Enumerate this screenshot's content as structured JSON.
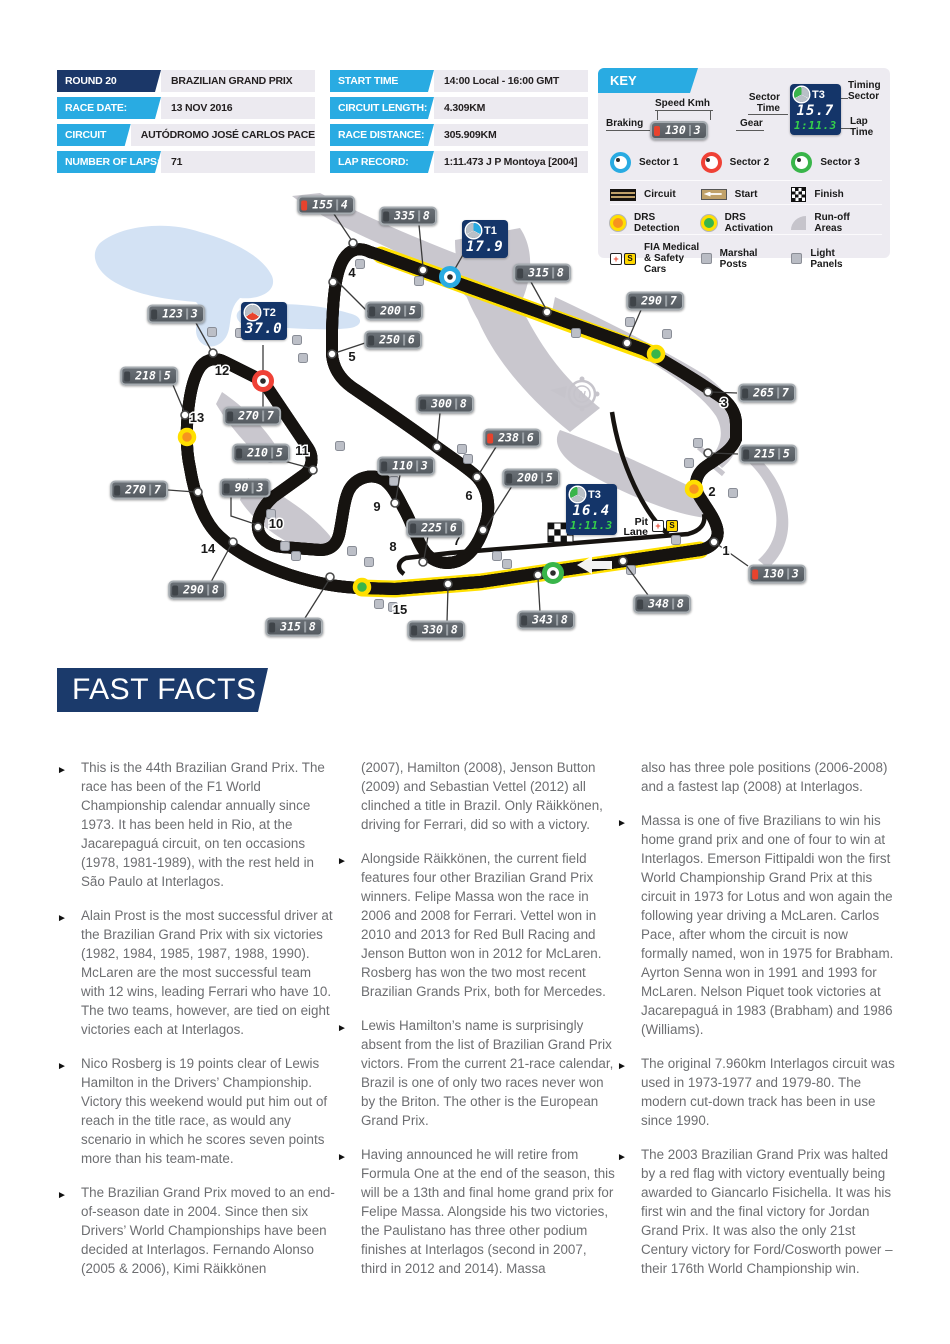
{
  "info_tables": {
    "left": {
      "rows": [
        {
          "label": "ROUND 20",
          "value": "BRAZILIAN GRAND PRIX",
          "variant": "navy"
        },
        {
          "label": "RACE DATE:",
          "value": "13 NOV 2016",
          "variant": "cyan"
        },
        {
          "label": "CIRCUIT NAME:",
          "value": "AUTÓDROMO JOSÉ CARLOS PACE",
          "variant": "cyan"
        },
        {
          "label": "NUMBER OF LAPS:",
          "value": "71",
          "variant": "cyan"
        }
      ]
    },
    "right": {
      "rows": [
        {
          "label": "START TIME",
          "value": "14:00 Local - 16:00 GMT",
          "variant": "cyan"
        },
        {
          "label": "CIRCUIT LENGTH:",
          "value": "4.309KM",
          "variant": "cyan"
        },
        {
          "label": "RACE DISTANCE:",
          "value": "305.909KM",
          "variant": "cyan"
        },
        {
          "label": "LAP RECORD:",
          "value": "1:11.473 J P Montoya [2004]",
          "variant": "cyan"
        }
      ]
    }
  },
  "key": {
    "title": "KEY",
    "speed_example": {
      "braking_label": "Braking",
      "speed_label": "Speed Kmh",
      "gear_label": "Gear",
      "speed": "130",
      "gear": "3"
    },
    "timing_example": {
      "sector_time_label": "Sector\nTime",
      "timing_sector_label": "Timing\nSector",
      "lap_time_label": "Lap\nTime",
      "sector_id": "T3",
      "sector_time": "15.7",
      "lap_time": "1:11.3"
    },
    "icon_glyphs": {
      "plus": "+",
      "safety": "S"
    },
    "sectors": [
      {
        "label": "Sector 1",
        "color": "#29abe2"
      },
      {
        "label": "Sector 2",
        "color": "#ef4136"
      },
      {
        "label": "Sector 3",
        "color": "#39b54a"
      }
    ],
    "track_items": [
      {
        "label": "Circuit",
        "icon": "circuit"
      },
      {
        "label": "Start",
        "icon": "start"
      },
      {
        "label": "Finish",
        "icon": "finish"
      }
    ],
    "drs_items": [
      {
        "label": "DRS\nDetection",
        "icon": "drs-detection"
      },
      {
        "label": "DRS\nActivation",
        "icon": "drs-activation"
      },
      {
        "label": "Run-off\nAreas",
        "icon": "runoff"
      }
    ],
    "misc_items": [
      {
        "label": "FIA Medical\n& Safety Cars",
        "icon": "medical-safety"
      },
      {
        "label": "Marshal\nPosts",
        "icon": "marshal"
      },
      {
        "label": "Light\nPanels",
        "icon": "light-panel"
      }
    ]
  },
  "map": {
    "compass_label": "N",
    "pit_lane_label": {
      "line1": "Pit",
      "line2": "Lane"
    },
    "colors": {
      "track_tan": "#c0a169",
      "drs_zone": "#ffe000",
      "sector1": "#29abe2",
      "sector2": "#ef4136",
      "sector3": "#39b54a",
      "timing_navy": "#143569"
    },
    "speed_boxes": [
      {
        "s": "155",
        "g": "4",
        "r": true,
        "cx": 326,
        "cy": 205,
        "ln": [
          [
            334,
            214
          ],
          [
            352,
            241
          ]
        ],
        "dot": [
          353,
          243
        ]
      },
      {
        "s": "335",
        "g": "8",
        "cx": 408,
        "cy": 216,
        "ln": [
          [
            419,
            225
          ],
          [
            423,
            267
          ]
        ],
        "dot": [
          423,
          270
        ]
      },
      {
        "s": "315",
        "g": "8",
        "cx": 542,
        "cy": 273,
        "ln": [
          [
            531,
            282
          ],
          [
            546,
            309
          ]
        ],
        "dot": [
          547,
          312
        ]
      },
      {
        "s": "290",
        "g": "7",
        "cx": 655,
        "cy": 301,
        "ln": [
          [
            641,
            310
          ],
          [
            628,
            340
          ]
        ],
        "dot": [
          627,
          343
        ]
      },
      {
        "s": "265",
        "g": "7",
        "cx": 767,
        "cy": 393,
        "ln": [
          [
            737,
            393
          ],
          [
            711,
            392
          ]
        ],
        "dot": [
          708,
          392
        ]
      },
      {
        "s": "215",
        "g": "5",
        "cx": 768,
        "cy": 454,
        "ln": [
          [
            738,
            454
          ],
          [
            711,
            453
          ]
        ],
        "dot": [
          708,
          453
        ]
      },
      {
        "s": "130",
        "g": "3",
        "r": true,
        "cx": 777,
        "cy": 574,
        "ln": [
          [
            748,
            566
          ],
          [
            717,
            544
          ]
        ],
        "dot": [
          714,
          542
        ]
      },
      {
        "s": "348",
        "g": "8",
        "cx": 662,
        "cy": 604,
        "ln": [
          [
            648,
            595
          ],
          [
            625,
            564
          ]
        ],
        "dot": [
          623,
          561
        ]
      },
      {
        "s": "343",
        "g": "8",
        "cx": 546,
        "cy": 620,
        "ln": [
          [
            540,
            612
          ],
          [
            538,
            578
          ]
        ],
        "dot": [
          538,
          575
        ]
      },
      {
        "s": "330",
        "g": "8",
        "cx": 436,
        "cy": 630,
        "ln": [
          [
            447,
            622
          ],
          [
            448,
            587
          ]
        ],
        "dot": [
          448,
          584
        ]
      },
      {
        "s": "315",
        "g": "8",
        "cx": 294,
        "cy": 627,
        "ln": [
          [
            305,
            618
          ],
          [
            329,
            580
          ]
        ],
        "dot": [
          330,
          577
        ]
      },
      {
        "s": "290",
        "g": "8",
        "cx": 197,
        "cy": 590,
        "ln": [
          [
            211,
            582
          ],
          [
            231,
            545
          ]
        ],
        "dot": [
          233,
          542
        ]
      },
      {
        "s": "270",
        "g": "7",
        "cx": 139,
        "cy": 490,
        "ln": [
          [
            168,
            490
          ],
          [
            195,
            492
          ]
        ],
        "dot": [
          198,
          492
        ]
      },
      {
        "s": "218",
        "g": "5",
        "cx": 149,
        "cy": 376,
        "ln": [
          [
            173,
            385
          ],
          [
            184,
            411
          ]
        ],
        "dot": [
          185,
          415
        ]
      },
      {
        "s": "123",
        "g": "3",
        "cx": 176,
        "cy": 314,
        "ln": [
          [
            196,
            323
          ],
          [
            211,
            350
          ]
        ],
        "dot": [
          213,
          353
        ]
      },
      {
        "s": "270",
        "g": "7",
        "cx": 252,
        "cy": 416,
        "ln": [
          [
            263,
            407
          ],
          [
            263,
            390
          ]
        ]
      },
      {
        "s": "210",
        "g": "5",
        "cx": 261,
        "cy": 453,
        "ln": [
          [
            284,
            461
          ],
          [
            310,
            468
          ]
        ],
        "dot": [
          313,
          470
        ]
      },
      {
        "s": "90",
        "g": "3",
        "cx": 245,
        "cy": 488,
        "ln": [
          [
            231,
            496
          ],
          [
            231,
            516
          ],
          [
            255,
            524
          ]
        ],
        "dot": [
          258,
          527
        ]
      },
      {
        "s": "110",
        "g": "3",
        "cx": 406,
        "cy": 466,
        "ln": [
          [
            400,
            475
          ],
          [
            396,
            499
          ]
        ],
        "dot": [
          395,
          503
        ]
      },
      {
        "s": "225",
        "g": "6",
        "cx": 435,
        "cy": 528,
        "ln": [
          [
            428,
            536
          ],
          [
            424,
            559
          ]
        ],
        "dot": [
          423,
          562
        ]
      },
      {
        "s": "200",
        "g": "5",
        "cx": 531,
        "cy": 478,
        "ln": [
          [
            512,
            486
          ],
          [
            486,
            527
          ]
        ],
        "dot": [
          483,
          530
        ]
      },
      {
        "s": "238",
        "g": "6",
        "r": true,
        "cx": 512,
        "cy": 438,
        "ln": [
          [
            496,
            447
          ],
          [
            479,
            474
          ]
        ],
        "dot": [
          477,
          477
        ]
      },
      {
        "s": "300",
        "g": "8",
        "cx": 445,
        "cy": 404,
        "ln": [
          [
            440,
            413
          ],
          [
            437,
            444
          ]
        ],
        "dot": [
          437,
          447
        ]
      },
      {
        "s": "200",
        "g": "5",
        "cx": 394,
        "cy": 311,
        "ln": [
          [
            376,
            320
          ],
          [
            336,
            280
          ]
        ],
        "dot": [
          333,
          282
        ]
      },
      {
        "s": "250",
        "g": "6",
        "cx": 393,
        "cy": 340,
        "ln": [
          [
            365,
            343
          ],
          [
            335,
            353
          ]
        ],
        "dot": [
          332,
          354
        ]
      }
    ],
    "timing_boxes": [
      {
        "id": "T1",
        "time": "17.9",
        "seg": "right",
        "x": 462,
        "y": 220,
        "ln": [
          [
            464,
            253
          ],
          [
            452,
            274
          ]
        ]
      },
      {
        "id": "T2",
        "time": "37.0",
        "seg": "bottom",
        "x": 241,
        "y": 302,
        "ln": [
          [
            263,
            345
          ],
          [
            263,
            374
          ]
        ]
      },
      {
        "id": "T3",
        "time": "16.4",
        "lap": "1:11.3",
        "seg": "left",
        "x": 566,
        "y": 484
      }
    ],
    "turns": [
      {
        "n": "1",
        "x": 726,
        "y": 555
      },
      {
        "n": "2",
        "x": 712,
        "y": 496
      },
      {
        "n": "3",
        "x": 724,
        "y": 407
      },
      {
        "n": "4",
        "x": 352,
        "y": 277
      },
      {
        "n": "5",
        "x": 352,
        "y": 361
      },
      {
        "n": "6",
        "x": 469,
        "y": 500
      },
      {
        "n": "7",
        "x": 457,
        "y": 545
      },
      {
        "n": "8",
        "x": 393,
        "y": 551
      },
      {
        "n": "9",
        "x": 377,
        "y": 511
      },
      {
        "n": "10",
        "x": 276,
        "y": 528
      },
      {
        "n": "11",
        "x": 302,
        "y": 455
      },
      {
        "n": "12",
        "x": 222,
        "y": 375
      },
      {
        "n": "13",
        "x": 197,
        "y": 422
      },
      {
        "n": "14",
        "x": 208,
        "y": 553
      },
      {
        "n": "15",
        "x": 400,
        "y": 614
      }
    ],
    "sector_markers": [
      {
        "color": "#29abe2",
        "x": 450,
        "y": 277
      },
      {
        "color": "#ef4136",
        "x": 263,
        "y": 381
      },
      {
        "color": "#39b54a",
        "x": 553,
        "y": 573
      }
    ],
    "drs_markers": [
      {
        "type": "detection",
        "x": 187,
        "y": 437
      },
      {
        "type": "detection",
        "x": 694,
        "y": 489
      },
      {
        "type": "activation",
        "x": 656,
        "y": 354
      },
      {
        "type": "activation",
        "x": 362,
        "y": 587
      }
    ],
    "marshal_posts": [
      [
        212,
        332
      ],
      [
        240,
        333
      ],
      [
        360,
        264
      ],
      [
        419,
        281
      ],
      [
        297,
        340
      ],
      [
        303,
        358
      ],
      [
        576,
        333
      ],
      [
        630,
        322
      ],
      [
        667,
        334
      ],
      [
        340,
        446
      ],
      [
        462,
        449
      ],
      [
        468,
        459
      ],
      [
        394,
        481
      ],
      [
        271,
        514
      ],
      [
        285,
        546
      ],
      [
        296,
        556
      ],
      [
        352,
        551
      ],
      [
        369,
        562
      ],
      [
        497,
        556
      ],
      [
        507,
        564
      ],
      [
        379,
        604
      ],
      [
        393,
        607
      ],
      [
        698,
        443
      ],
      [
        689,
        463
      ],
      [
        733,
        493
      ],
      [
        676,
        540
      ],
      [
        631,
        570
      ]
    ]
  },
  "fast_facts": {
    "title": "FAST FACTS",
    "columns": [
      {
        "items": [
          {
            "bullet": true,
            "text": "This is the 44th Brazilian Grand Prix. The race has been of the F1 World Championship calendar annually since 1973. It has been held in Rio, at the Jacarepaguá circuit, on ten occasions (1978, 1981-1989), with the rest held in São Paulo at Interlagos."
          },
          {
            "bullet": true,
            "text": "Alain Prost is the most successful driver at the Brazilian Grand Prix with six victories (1982, 1984, 1985, 1987, 1988, 1990). McLaren are the most successful team with 12 wins, leading Ferrari who have 10. The two teams, however, are tied on eight victories each at Interlagos."
          },
          {
            "bullet": true,
            "text": "Nico Rosberg is 19 points clear of Lewis Hamilton in the Drivers’ Championship. Victory this weekend would put him out of reach in the title race, as would any scenario in which he scores seven points more than his team-mate."
          },
          {
            "bullet": true,
            "text": "The Brazilian Grand Prix moved to an end-of-season date in 2004. Since then six Drivers’ World Championships have been decided at Interlagos. Fernando Alonso (2005 & 2006), Kimi Räikkönen"
          }
        ]
      },
      {
        "items": [
          {
            "bullet": false,
            "text": "(2007), Hamilton (2008), Jenson Button (2009) and Sebastian Vettel (2012) all clinched a title in Brazil. Only Räikkönen, driving for Ferrari, did so with a victory."
          },
          {
            "bullet": true,
            "text": "Alongside Räikkönen, the current field features four other Brazilian Grand Prix winners. Felipe Massa won the race in 2006 and 2008 for Ferrari. Vettel won in 2010 and 2013 for Red Bull Racing and Jenson Button won in 2012 for McLaren. Rosberg has won the two most recent Brazilian Grands Prix, both for Mercedes."
          },
          {
            "bullet": true,
            "text": "Lewis Hamilton’s name is surprisingly absent from the list of Brazilian Grand Prix victors. From the current 21-race calendar, Brazil is one of only two races never won by the Briton. The other is the European Grand Prix."
          },
          {
            "bullet": true,
            "text": "Having announced he will retire from Formula One at the end of the season, this will be a 13th and final home grand prix for Felipe Massa. Alongside his two victories, the Paulistano has three other podium finishes at Interlagos (second in 2007, third in 2012 and 2014). Massa"
          }
        ]
      },
      {
        "items": [
          {
            "bullet": false,
            "text": "also has three pole positions (2006-2008) and a fastest lap (2008) at Interlagos."
          },
          {
            "bullet": true,
            "text": "Massa is one of five Brazilians to win his home grand prix and one of four to win at Interlagos. Emerson Fittipaldi won the first World Championship Grand Prix at this circuit in 1973 for Lotus and won again the following year driving a McLaren. Carlos Pace, after whom the circuit is now formally named, won in 1975 for Brabham. Ayrton Senna won in 1991 and 1993 for McLaren. Nelson Piquet took victories at Jacarepaguá in 1983 (Brabham) and 1986 (Williams)."
          },
          {
            "bullet": true,
            "text": "The original 7.960km Interlagos circuit was used in 1973-1977 and 1979-80. The modern cut-down track has been in use since 1990."
          },
          {
            "bullet": true,
            "text": "The 2003 Brazilian Grand Prix was halted by a red flag with victory eventually being awarded to Giancarlo Fisichella. It was his first win and the final victory for Jordan Grand Prix. It was also the only 21st Century victory for Ford/Cosworth power – their 176th World Championship win."
          }
        ]
      }
    ]
  }
}
